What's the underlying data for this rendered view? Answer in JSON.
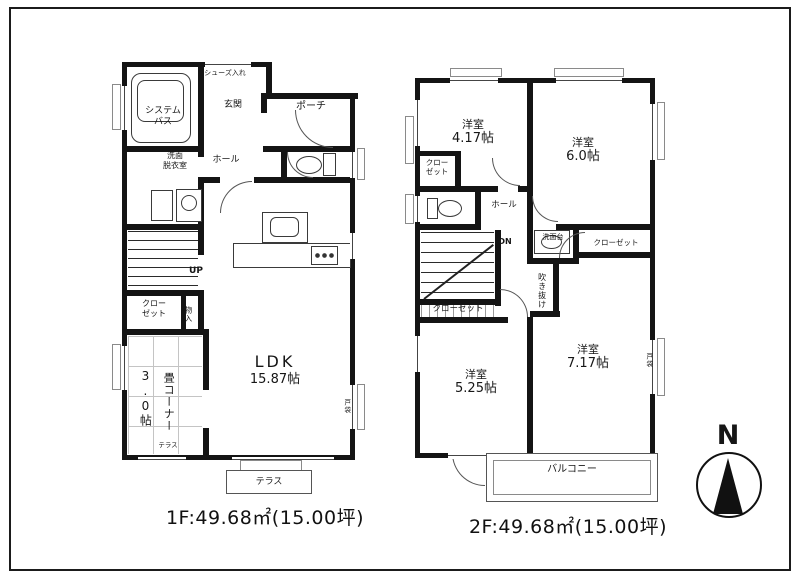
{
  "compass": {
    "label": "N"
  },
  "floor1": {
    "caption": "1F:49.68㎡(15.00坪)",
    "labels": {
      "shoe_box": "シューズ入れ",
      "entrance": "玄関",
      "porch": "ポーチ",
      "hall": "ホール",
      "bath_l1": "システム",
      "bath_l2": "バス",
      "wash_l1": "洗面",
      "wash_l2": "脱衣室",
      "stairs": "UP",
      "closet_l1": "クロー",
      "closet_l2": "ゼット",
      "storage": "物入",
      "tatami_name": "畳コーナー",
      "tatami_size": "3.0帖",
      "ldk_l1": "LDK",
      "ldk_l2": "15.87帖",
      "terrace_step": "テラス",
      "terrace": "テラス",
      "shutter": "戸袋"
    }
  },
  "floor2": {
    "caption": "2F:49.68㎡(15.00坪)",
    "labels": {
      "bed1_l1": "洋室",
      "bed1_l2": "4.17帖",
      "bed2_l1": "洋室",
      "bed2_l2": "6.0帖",
      "bed3_l1": "洋室",
      "bed3_l2": "5.25帖",
      "bed4_l1": "洋室",
      "bed4_l2": "7.17帖",
      "closet_a_l1": "クロー",
      "closet_a_l2": "ゼット",
      "closet_b": "クローゼット",
      "closet_c": "クローゼット",
      "vanity": "洗面台",
      "hall": "ホール",
      "stairs": "DN",
      "void": "吹き抜け",
      "balcony": "バルコニー",
      "shutter": "戸袋"
    }
  }
}
